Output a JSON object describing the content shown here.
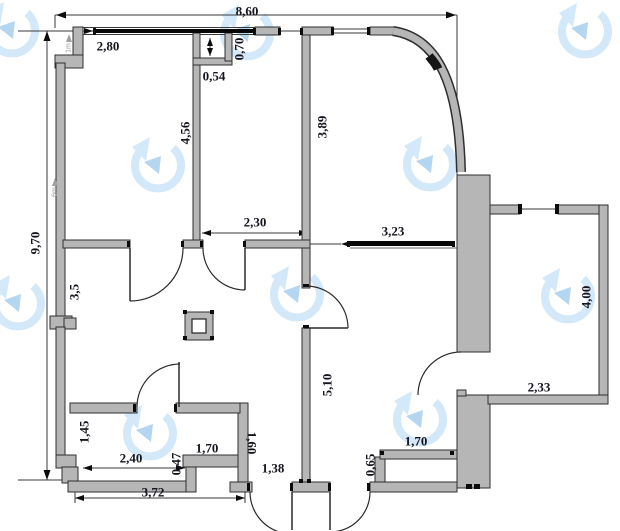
{
  "drawing": {
    "kind": "apartment floor plan",
    "units": "meters"
  },
  "colors": {
    "wall_fill": "#b6b6b6",
    "wall_stroke": "#2f2f2f",
    "window": "#070707",
    "dim_text": "#14141f",
    "line": "#3a3a3a",
    "watermark_ring": "#d3e8f8",
    "watermark_arrow": "#b4d6f0",
    "marker": "#9b9b9b"
  },
  "dimensions": [
    {
      "id": "overall-width",
      "text": "8,60",
      "x": 247,
      "y": 11,
      "rot": 0
    },
    {
      "id": "left-top-width",
      "text": "2,80",
      "x": 108,
      "y": 46,
      "rot": 0
    },
    {
      "id": "niche-depth",
      "text": "0,70",
      "x": 239,
      "y": 49,
      "rot": -90
    },
    {
      "id": "niche-width",
      "text": "0,54",
      "x": 214,
      "y": 76,
      "rot": 0
    },
    {
      "id": "wall-4-56",
      "text": "4,56",
      "x": 185,
      "y": 133,
      "rot": -90
    },
    {
      "id": "wall-3-89",
      "text": "3,89",
      "x": 322,
      "y": 127,
      "rot": -90
    },
    {
      "id": "overall-height",
      "text": "9,70",
      "x": 35,
      "y": 243,
      "rot": -90
    },
    {
      "id": "hall-width",
      "text": "2,30",
      "x": 255,
      "y": 222,
      "rot": 0
    },
    {
      "id": "room-width",
      "text": "3,23",
      "x": 393,
      "y": 231,
      "rot": 0
    },
    {
      "id": "wall-3-5",
      "text": "3,5",
      "x": 74,
      "y": 292,
      "rot": -90
    },
    {
      "id": "balcony-height",
      "text": "4,00",
      "x": 586,
      "y": 297,
      "rot": -90
    },
    {
      "id": "balcony-width",
      "text": "2,33",
      "x": 539,
      "y": 387,
      "rot": 0
    },
    {
      "id": "wall-5-10",
      "text": "5,10",
      "x": 327,
      "y": 385,
      "rot": -90
    },
    {
      "id": "bath-height",
      "text": "1,45",
      "x": 84,
      "y": 432,
      "rot": -90
    },
    {
      "id": "bath-width",
      "text": "2,40",
      "x": 131,
      "y": 458,
      "rot": 0
    },
    {
      "id": "step-0-47",
      "text": "0,47",
      "x": 176,
      "y": 464,
      "rot": -90
    },
    {
      "id": "cell-width",
      "text": "1,70",
      "x": 207,
      "y": 448,
      "rot": 0
    },
    {
      "id": "cell-height",
      "text": "1,60",
      "x": 252,
      "y": 443,
      "rot": 90
    },
    {
      "id": "dim-1-38",
      "text": "1,38",
      "x": 273,
      "y": 468,
      "rot": 0
    },
    {
      "id": "bottom-width",
      "text": "3,72",
      "x": 153,
      "y": 492,
      "rot": 0
    },
    {
      "id": "bar-height",
      "text": "0,65",
      "x": 370,
      "y": 465,
      "rot": -90
    },
    {
      "id": "bar-width",
      "text": "1,70",
      "x": 416,
      "y": 441,
      "rot": 0
    }
  ],
  "markers": [
    {
      "id": "marker-1m",
      "text": "1m",
      "x": 68,
      "y": 48,
      "rot": -90
    },
    {
      "id": "marker-6m",
      "text": "6m",
      "x": 54,
      "y": 192,
      "rot": -90
    }
  ],
  "watermark": {
    "icon": "circular-arrow-logo",
    "count": 10
  }
}
